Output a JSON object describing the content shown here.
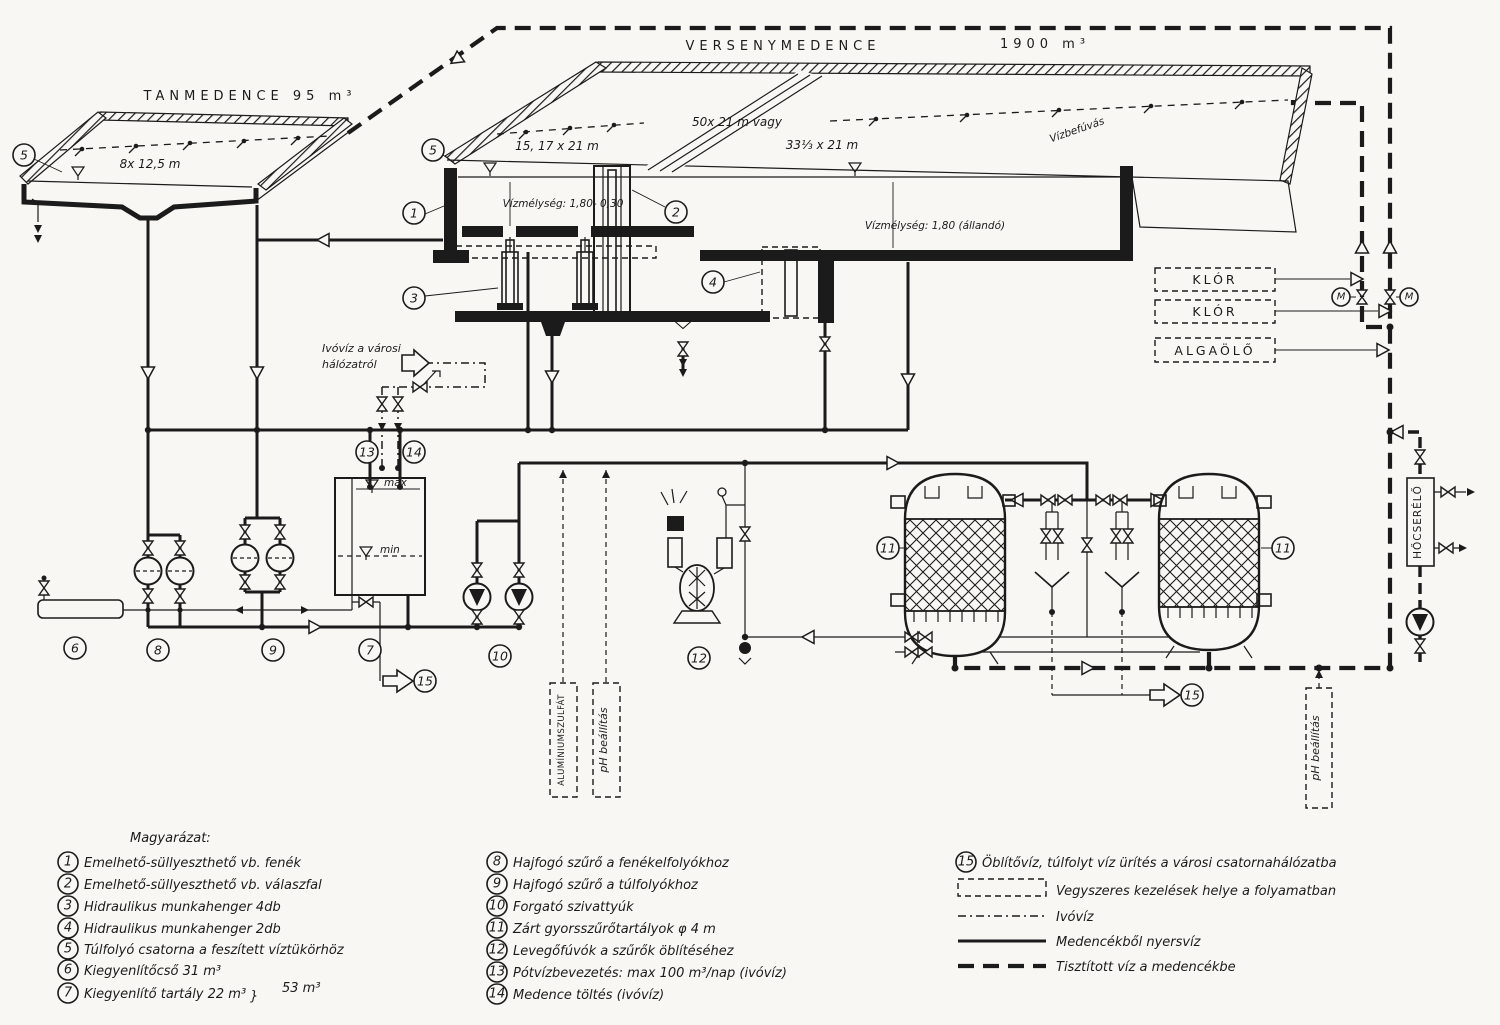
{
  "pools": {
    "tan": {
      "title": "TANMEDENCE  95 m³",
      "dim": "8x 12,5 m"
    },
    "verseny": {
      "title": "VERSENYMEDENCE",
      "volume": "1900 m³",
      "dim_combined": "50x 21 m  vagy",
      "dim_left": "15, 17 x 21 m",
      "dim_right": "33⅓  x 21 m",
      "inlet": "Vízbefúvás",
      "depth_left": "Vízmélység: 1,80- 0,30",
      "depth_right": "Vízmélység: 1,80 (állandó)"
    }
  },
  "boxes": {
    "chlorine1": "KLÓR",
    "chlorine2": "KLÓR",
    "algicide": "ALGAÖLŐ",
    "heat_exchanger": "HŐCSERÉLŐ",
    "alum": "ALUMÍNIUMSZULFÁT",
    "ph_mid": "pH beállítás",
    "ph_right": "pH beállítás"
  },
  "notes": {
    "city_water_1": "Ivóvíz a városi",
    "city_water_2": "hálózatról",
    "max": "max",
    "min": "min"
  },
  "markers": {
    "n1": "1",
    "n2": "2",
    "n3": "3",
    "n4": "4",
    "n5": "5",
    "n6": "6",
    "n7": "7",
    "n8": "8",
    "n9": "9",
    "n10": "10",
    "n11": "11",
    "n12": "12",
    "n13": "13",
    "n14": "14",
    "n15": "15",
    "motor": "M"
  },
  "legend": {
    "title": "Magyarázat:",
    "items": [
      {
        "num": "1",
        "text": "Emelhető-süllyeszthető vb. fenék"
      },
      {
        "num": "2",
        "text": "Emelhető-süllyeszthető vb. válaszfal"
      },
      {
        "num": "3",
        "text": "Hidraulikus munkahenger  4db"
      },
      {
        "num": "4",
        "text": "Hidraulikus munkahenger  2db"
      },
      {
        "num": "5",
        "text": "Túlfolyó csatorna a feszített víztükörhöz"
      },
      {
        "num": "6",
        "text": "Kiegyenlítőcső  31 m³"
      },
      {
        "num": "7",
        "text": "Kiegyenlítő tartály  22 m³"
      },
      {
        "num": "8",
        "text": "Hajfogó szűrő a fenékelfolyókhoz"
      },
      {
        "num": "9",
        "text": "Hajfogó szűrő a túlfolyókhoz"
      },
      {
        "num": "10",
        "text": "Forgató szivattyúk"
      },
      {
        "num": "11",
        "text": "Zárt gyorsszűrőtartályok  φ 4 m"
      },
      {
        "num": "12",
        "text": "Levegőfúvók a szűrők öblítéséhez"
      },
      {
        "num": "13",
        "text": "Pótvízbevezetés: max 100 m³/nap (ivóvíz)"
      },
      {
        "num": "14",
        "text": "Medence töltés (ivóvíz)"
      },
      {
        "num": "15",
        "text": "Öblítővíz, túlfolyt víz ürítés a városi csatornahálózatba"
      }
    ],
    "sum_brace": "}",
    "sum_value": "53 m³",
    "lines": [
      {
        "label": "Vegyszeres kezelések  helye a folyamatban"
      },
      {
        "label": "Ivóvíz"
      },
      {
        "label": "Medencékből nyersvíz"
      },
      {
        "label": "Tisztított víz a medencékbe"
      }
    ]
  }
}
